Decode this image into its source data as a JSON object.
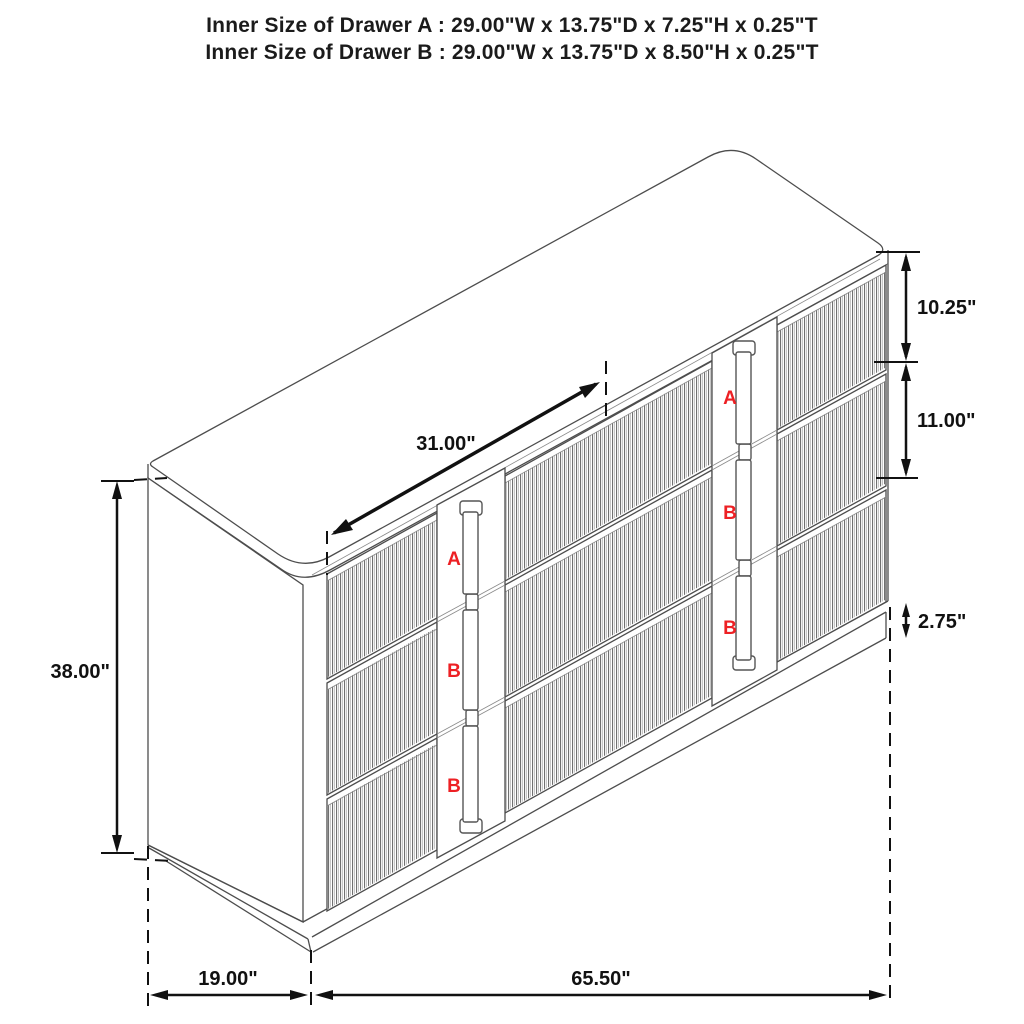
{
  "title": {
    "line1": "Inner Size of Drawer A : 29.00\"W x 13.75\"D x 7.25\"H x 0.25\"T",
    "line2": "Inner Size of Drawer B : 29.00\"W x 13.75\"D x 8.50\"H x 0.25\"T"
  },
  "dimensions": {
    "overall_height": "38.00\"",
    "drawer_a_front_height": "10.25\"",
    "drawer_b_front_height": "11.00\"",
    "base_height": "2.75\"",
    "top_drawer_width": "31.00\"",
    "depth": "19.00\"",
    "width": "65.50\""
  },
  "drawer_labels": {
    "left": [
      "A",
      "B",
      "B"
    ],
    "right": [
      "A",
      "B",
      "B"
    ]
  },
  "colors": {
    "background": "#ffffff",
    "line": "#4d4d4d",
    "dimension_line": "#111111",
    "drawer_letter_red": "#ed2024",
    "text": "#1b1b1b"
  }
}
